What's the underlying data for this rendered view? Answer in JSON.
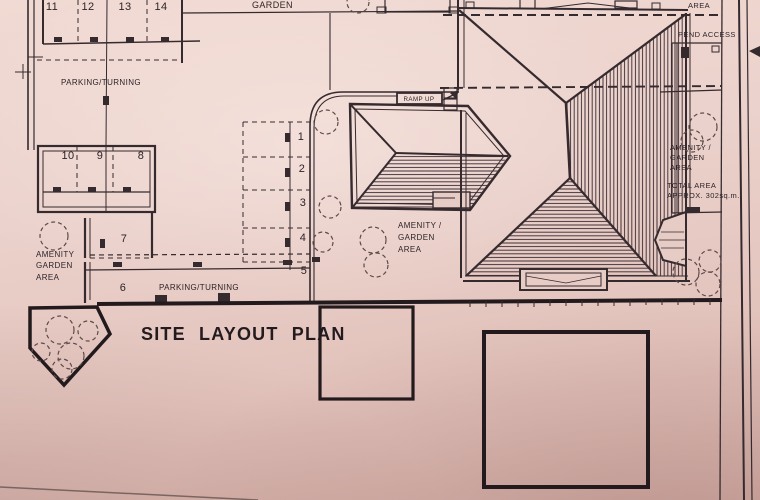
{
  "colors": {
    "paper": "#e9cec8",
    "ink": "#352a2e",
    "boundary": "#221a1d"
  },
  "title": {
    "text": "SITE LAYOUT PLAN"
  },
  "labels": {
    "garden_top": "GARDEN",
    "parking_turning_upper": "PARKING/TURNING",
    "parking_turning_lower": "PARKING/TURNING",
    "ramp_up": "RAMP UP",
    "area_top_right": "AREA",
    "pend_access": "PEND ACCESS",
    "amenity_left": {
      "l1": "AMENITY",
      "l2": "GARDEN",
      "l3": "AREA"
    },
    "amenity_center": {
      "l1": "AMENITY /",
      "l2": "GARDEN",
      "l3": "AREA"
    },
    "amenity_right": {
      "l1": "AMENITY /",
      "l2": "GARDEN",
      "l3": "AREA"
    },
    "total_area": {
      "l1": "TOTAL AREA",
      "l2": "APPROX. 302sq.m."
    }
  },
  "bays": {
    "b1": "1",
    "b2": "2",
    "b3": "3",
    "b4": "4",
    "b5": "5",
    "b6": "6",
    "b7": "7",
    "b8": "8",
    "b9": "9",
    "b10": "10",
    "b11": "11",
    "b12": "12",
    "b13": "13",
    "b14": "14"
  }
}
